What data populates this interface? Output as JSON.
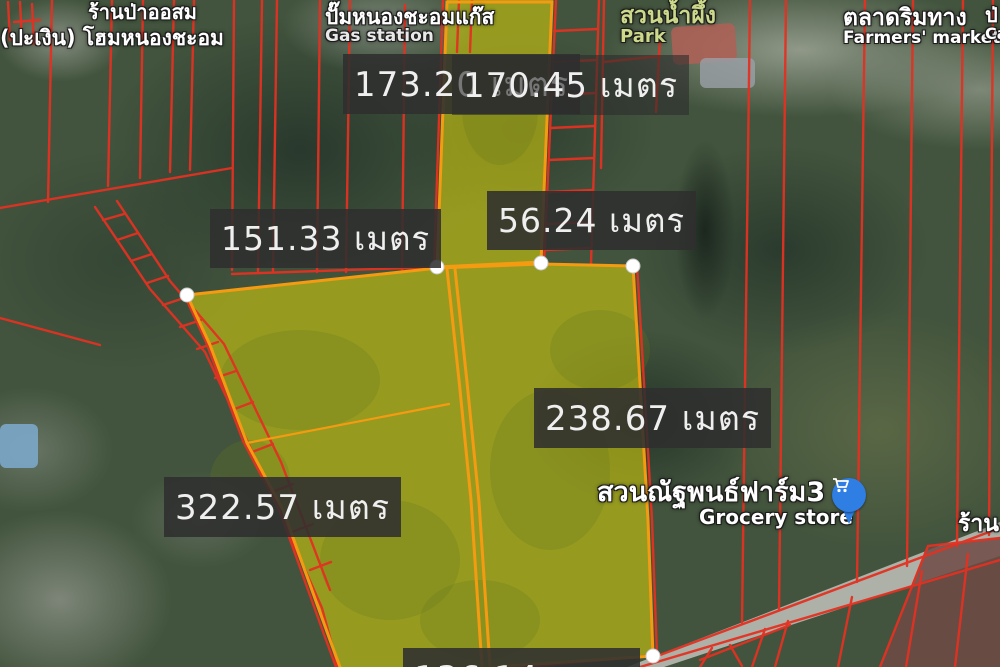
{
  "map": {
    "pois": {
      "shop_topleft": {
        "line1": "ร้านป่าออสม",
        "line2": "(ปะเงิน) โฮมหนองชะอม"
      },
      "gas_station": {
        "thai": "ปั๊มหนองชะอมแก๊ส",
        "en": "Gas station"
      },
      "park": {
        "thai": "สวนน้ำผึ้ง",
        "en": "Park"
      },
      "farmers_market": {
        "thai": "ตลาดริมทาง",
        "en": "Farmers' market"
      },
      "grocery": {
        "thai": "สวนณัฐพนธ์ฟาร์ม3",
        "en": "Grocery store"
      },
      "shop_right_partial": {
        "thai": "ร้าน"
      },
      "topright_partial": {
        "thai": "ป่",
        "en": "Ca"
      }
    },
    "measurements": {
      "top_a": "173.20 เมตร",
      "top_b": "170.45 เมตร",
      "left": "151.33 เมตร",
      "mid": "56.24 เมตร",
      "right": "238.67 เมตร",
      "bottom_left": "322.57 เมตร",
      "bottom_partial": "136.14 เมตร"
    },
    "colors": {
      "cadastral_line_red": "#e33122",
      "parcel_border_orange": "#f59b12",
      "parcel_fill_yellow": "rgba(221,213,10,0.55)",
      "measure_box_bg": "rgba(47,47,47,0.88)",
      "pin_blue": "#2e7ee4",
      "park_label_green": "#ccd98a"
    }
  }
}
